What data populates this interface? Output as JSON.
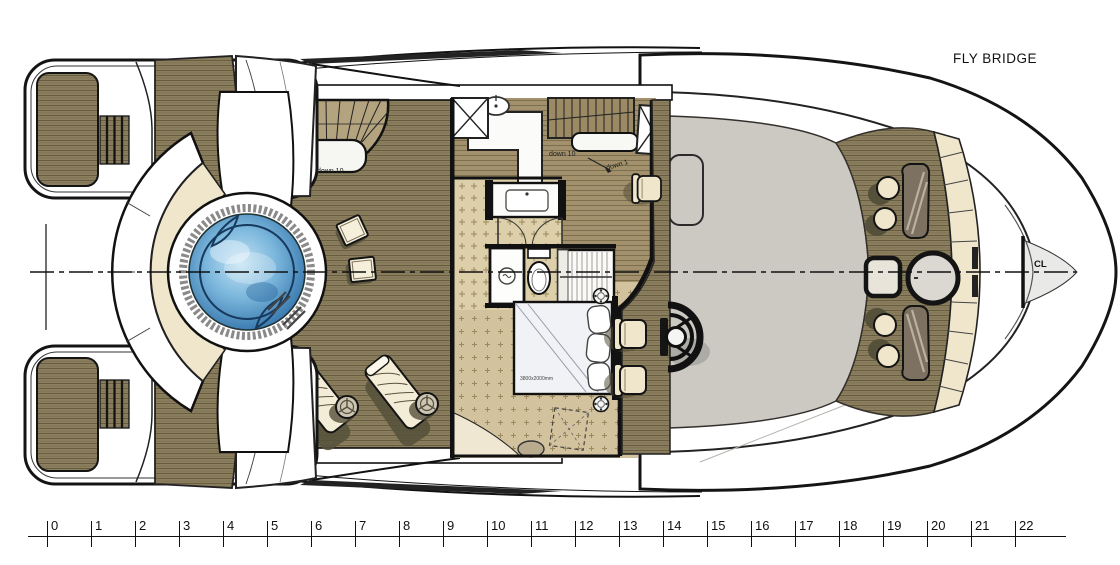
{
  "title": {
    "deck_name": "FLY BRIDGE"
  },
  "plan": {
    "centerline_label": "CL",
    "annotations": {
      "main_deck_stairs": "down 10",
      "cabin_stairs": "down 10",
      "cabin_step": "down 1",
      "bed_size": "3800x2000mm"
    },
    "features": [
      "spa-pool",
      "spa-curved-bench",
      "swim-platform-port",
      "swim-platform-starboard",
      "curved-staircase",
      "interior-staircase",
      "galley-counter",
      "galley-sink",
      "bathroom",
      "vanity-sink",
      "toilet",
      "shower",
      "wardrobe",
      "double-bed",
      "helm-station",
      "steering-wheel",
      "helm-chairs",
      "chaise-lounges",
      "side-tables",
      "bow-bench",
      "bow-round-table",
      "bow-square-seat",
      "bow-lounge-tables",
      "deck-hatches",
      "portholes",
      "coachroof"
    ]
  },
  "ruler": {
    "unit_values": [
      "0",
      "1",
      "2",
      "3",
      "4",
      "5",
      "6",
      "7",
      "8",
      "9",
      "10",
      "11",
      "12",
      "13",
      "14",
      "15",
      "16",
      "17",
      "18",
      "19",
      "20",
      "21",
      "22"
    ]
  },
  "colors": {
    "teak": "#8b7f5e",
    "teak_line": "#675c41",
    "teak_light": "#a2916c",
    "teak_light_line": "#7c6f4e",
    "cream": "#efe6cc",
    "gray_deck": "#ccc9c3",
    "taupe": "#a69888",
    "water": "#4f93c9",
    "water_deep": "#2d6ea6",
    "tile": "#dccfa9",
    "carpet": "#d2c39e",
    "pattern_mark": "#9c8a5e",
    "outline": "#141414",
    "shadow": "#55503a",
    "white": "#ffffff",
    "pale": "#e9e9e7"
  }
}
